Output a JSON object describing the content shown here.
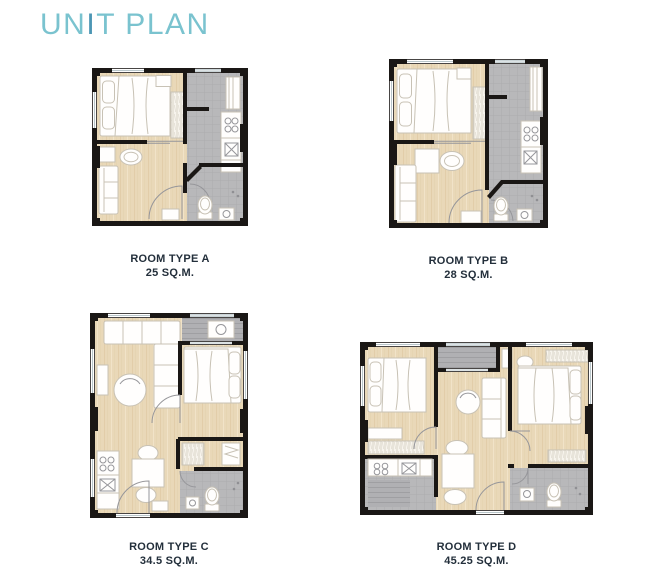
{
  "title": {
    "part1": "UN",
    "accent": "I",
    "part2": "T PLAN"
  },
  "units": [
    {
      "id": "A",
      "label": "ROOM TYPE A",
      "area": "25 SQ.M."
    },
    {
      "id": "B",
      "label": "ROOM TYPE B",
      "area": "28 SQ.M."
    },
    {
      "id": "C",
      "label": "ROOM TYPE C",
      "area": "34.5 SQ.M."
    },
    {
      "id": "D",
      "label": "ROOM TYPE D",
      "area": "45.25 SQ.M."
    }
  ],
  "colors": {
    "accent": "#7ac3cf",
    "accent-dark": "#4c96b4",
    "caption-text": "#232f3b",
    "wall": "#1a1715",
    "floor-base": "#e9d8b8",
    "tile-base": "#b8b8ba",
    "deck-base": "#b0b0b3",
    "furniture-stroke": "#c8c2b5",
    "background": "#ffffff"
  }
}
